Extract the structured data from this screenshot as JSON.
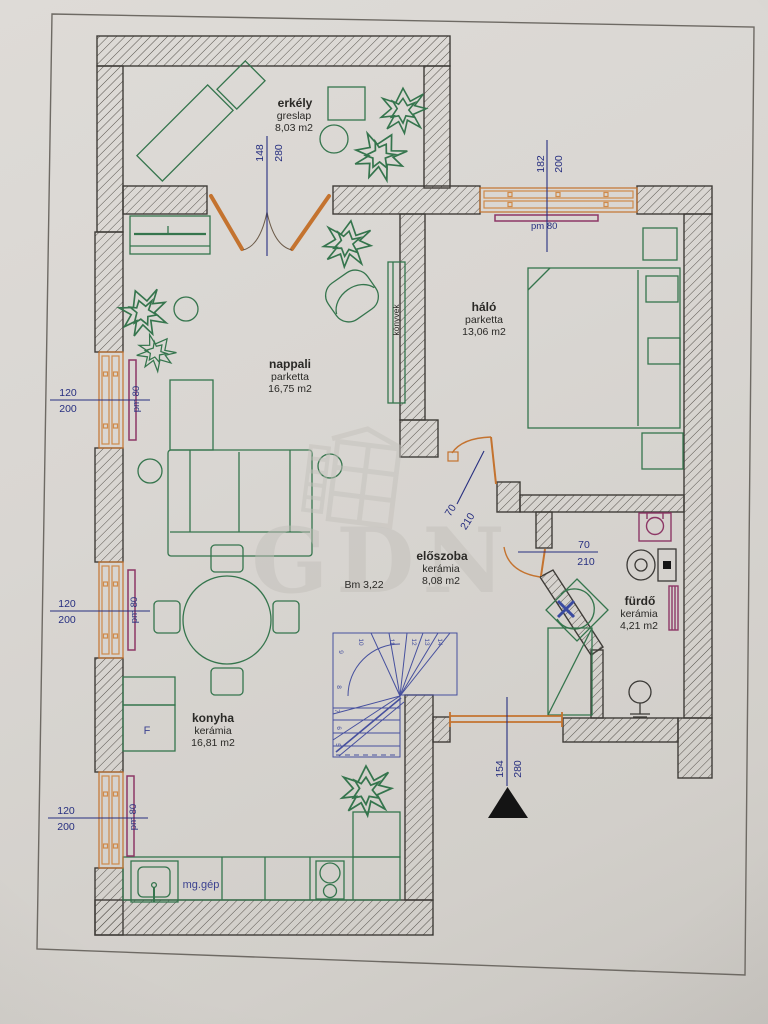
{
  "watermark": {
    "text": "GDN"
  },
  "rooms": [
    {
      "name": "erkély",
      "material": "greslap",
      "area": "8,03 m2"
    },
    {
      "name": "nappali",
      "material": "parketta",
      "area": "16,75 m2"
    },
    {
      "name": "háló",
      "material": "parketta",
      "area": "13,06 m2"
    },
    {
      "name": "előszoba",
      "material": "kerámia",
      "area": "8,08 m2"
    },
    {
      "name": "fürdő",
      "material": "kerámia",
      "area": "4,21 m2"
    },
    {
      "name": "konyha",
      "material": "kerámia",
      "area": "16,81 m2"
    }
  ],
  "annotations": {
    "ceiling_height": "Bm 3,22",
    "appliance": "mg.gép",
    "bookshelf": "könyvek",
    "fridge": "F"
  },
  "dimensions": {
    "balcony_door": {
      "width": "148",
      "height": "280"
    },
    "bedroom_window": {
      "width": "182",
      "height": "200",
      "parapet": "pm 80"
    },
    "left_window_1": {
      "width": "120",
      "height": "200",
      "parapet": "pm 80"
    },
    "left_window_2": {
      "width": "120",
      "height": "200",
      "parapet": "pm 80"
    },
    "left_window_3": {
      "width": "120",
      "height": "200",
      "parapet": "pm 80"
    },
    "bedroom_door": {
      "width": "70",
      "height": "210"
    },
    "bathroom_door": {
      "width": "70",
      "height": "210"
    },
    "entrance": {
      "width": "154",
      "height": "280"
    }
  },
  "stairs": {
    "numbers": [
      "5",
      "6",
      "7",
      "8",
      "9",
      "10",
      "11",
      "12",
      "13",
      "14"
    ]
  },
  "colors": {
    "wall_line": "#3f3c38",
    "furniture_green": "#35754d",
    "joinery_orange": "#c4732f",
    "dimension_blue": "#272f80",
    "fixture_purple": "#8d3766",
    "stair_blue": "#46509e",
    "paper": "#d8d5d1"
  }
}
